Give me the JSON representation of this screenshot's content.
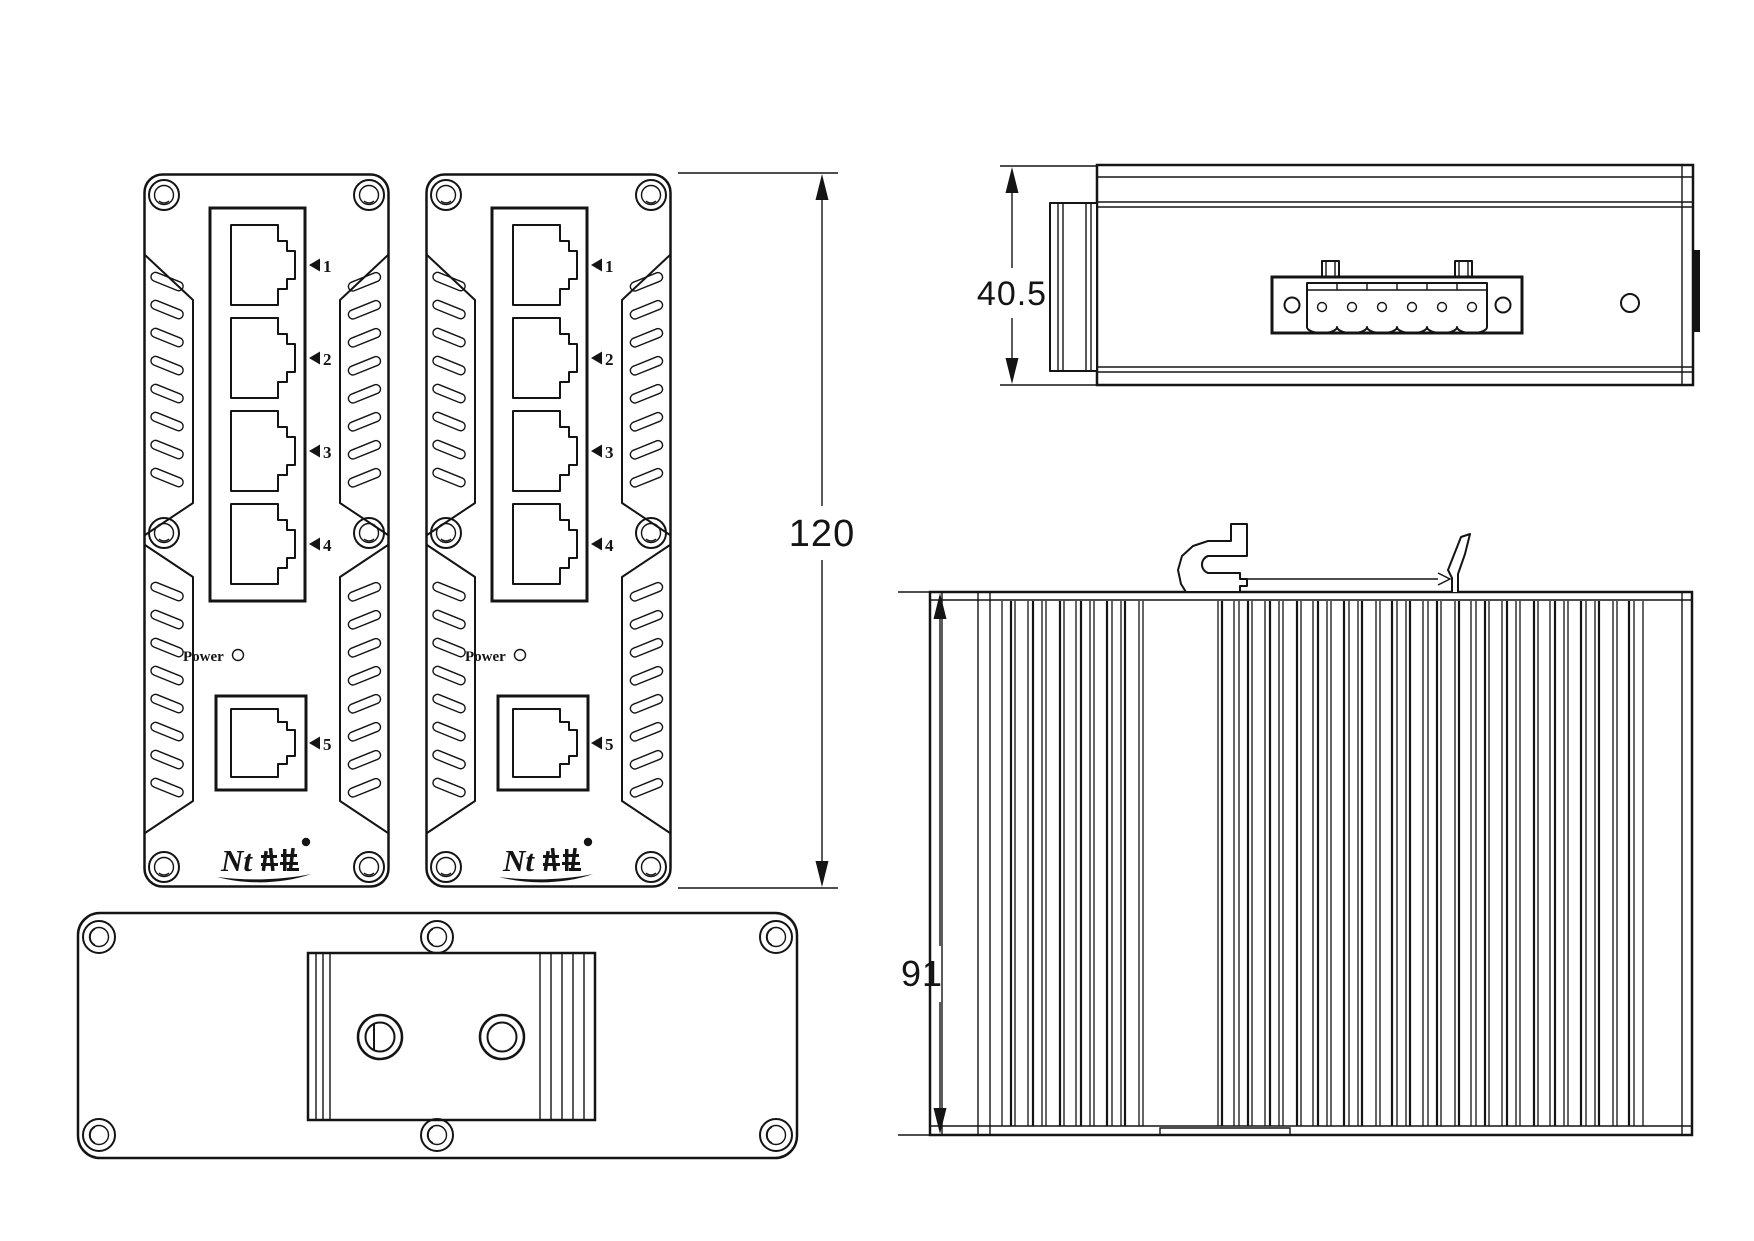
{
  "title": "industrial-ethernet-switch-dimension-drawing",
  "colors": {
    "background": "#ffffff",
    "line": "#141414"
  },
  "dims": {
    "front_height": "120",
    "top_depth": "40.5",
    "side_height": "91"
  },
  "front_panel": {
    "port_labels": [
      "1",
      "2",
      "3",
      "4",
      "5"
    ],
    "power_label": "Power",
    "logo_text": "Nt"
  }
}
